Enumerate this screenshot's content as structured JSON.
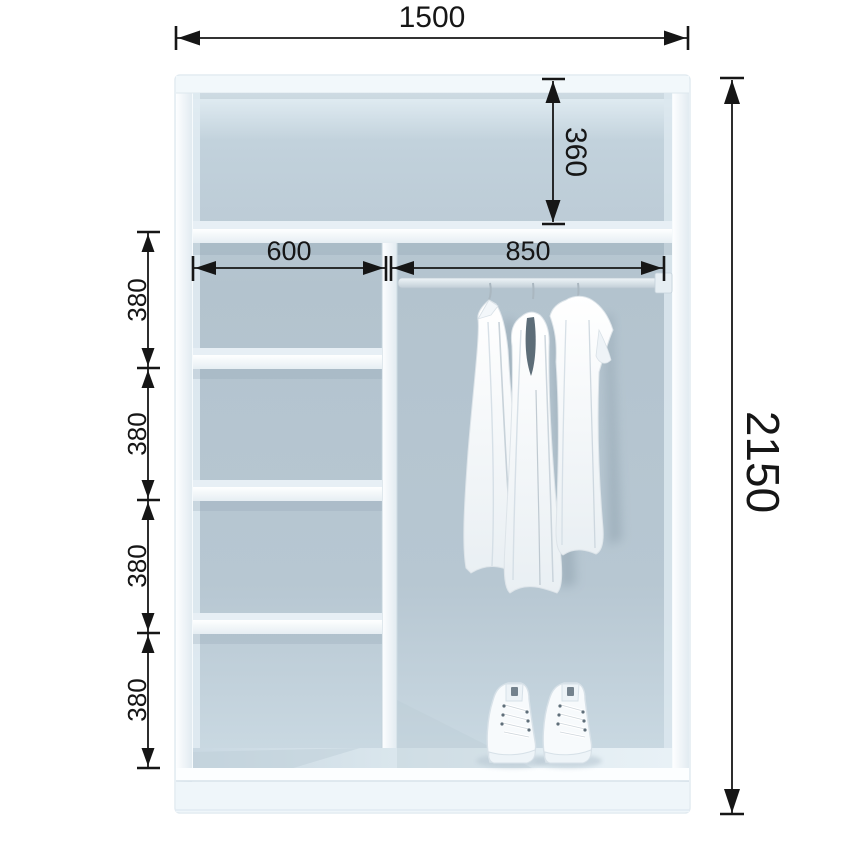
{
  "dimensions": {
    "overall_width": "1500",
    "overall_height": "2150",
    "top_compartment_height": "360",
    "shelf_section_width": "600",
    "hanging_section_width": "850",
    "shelf_gaps": [
      "380",
      "380",
      "380",
      "380"
    ]
  },
  "colors": {
    "annotation": "#161616",
    "frame_white": "#f7fbfd",
    "interior_mid": "#b3c3ce",
    "interior_light": "#d9e6ee",
    "background": "#ffffff",
    "garment_fold_dark": "#5d6d78"
  },
  "illustration": {
    "objects": [
      "hanging-rail",
      "slip-dress",
      "tank-dress",
      "t-shirt",
      "sneakers"
    ]
  }
}
